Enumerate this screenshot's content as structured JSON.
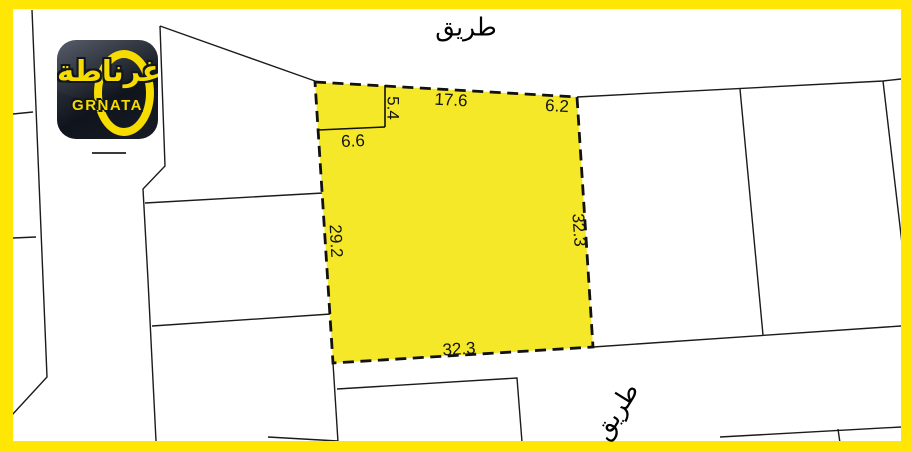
{
  "logo": {
    "brand_arabic": "غرناطة",
    "brand_latin": "GRNATA"
  },
  "roads": {
    "top": "طريق",
    "bottom": "طريق"
  },
  "plot": {
    "dim_notch_depth": "5.4",
    "dim_notch_width": "6.6",
    "dim_top": "17.6",
    "dim_top_right": "6.2",
    "dim_left": "29.2",
    "dim_right": "32.3",
    "dim_bottom": "32.3"
  },
  "colors": {
    "frame_yellow": "#FFE605",
    "plot_fill": "#F5E829",
    "parcel_line": "#1B1B1B",
    "plot_outline": "#111111",
    "logo_yellow": "#F6DC00",
    "logo_background": "#12161F"
  }
}
